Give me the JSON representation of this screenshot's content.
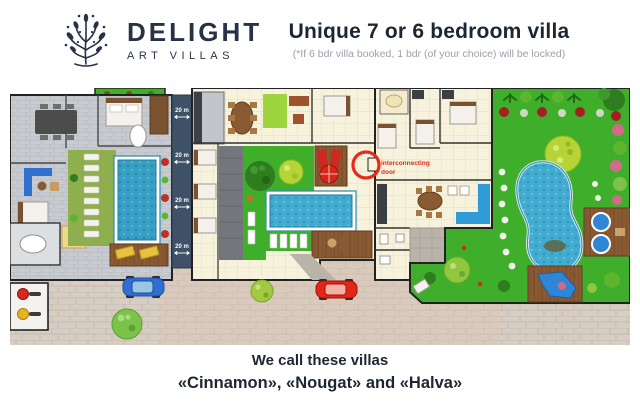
{
  "brand": {
    "name": "DELIGHT",
    "tagline": "ART VILLAS"
  },
  "header": {
    "title": "Unique 7 or 6 bedroom villa",
    "subtitle": "(*If 6 bdr villa booked, 1 bdr (of your choice) will be locked)"
  },
  "plan": {
    "distance_labels": [
      "20 m",
      "20 m",
      "20 m",
      "20 m"
    ],
    "annotation": {
      "line1": "interconnecting",
      "line2": "door"
    }
  },
  "footer": {
    "line1": "We call these villas",
    "line2": "«Cinnamon», «Nougat» and «Halva»"
  },
  "colors": {
    "brand_navy": "#273248",
    "text_dark": "#1d2733",
    "subtitle_gray": "#9aa1ab",
    "accent_red": "#e8291c",
    "lawn_green": "#3fae2a",
    "olive_lawn": "#8fae4e",
    "pool_blue": "#41abd0",
    "strip_navy": "#3e5166",
    "paving_tan": "#d7cec3",
    "deck_brown": "#8a5a33",
    "floor_cream": "#f7f2dc",
    "floor_gray": "#c8cbd0"
  }
}
